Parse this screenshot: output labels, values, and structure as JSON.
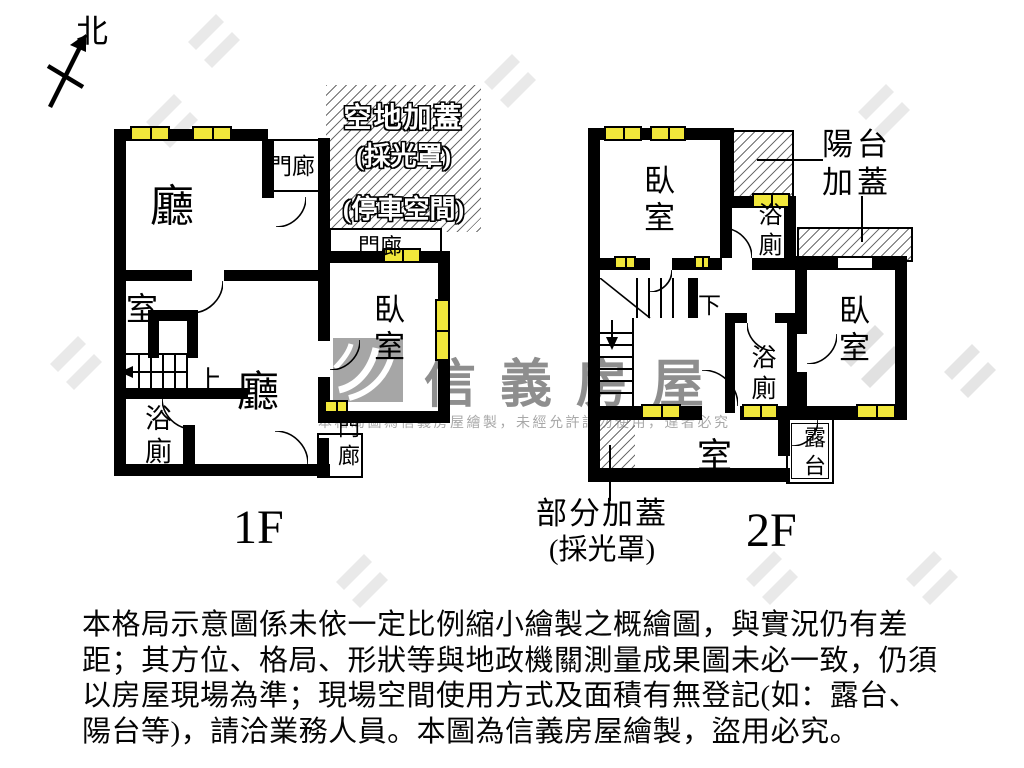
{
  "compass": {
    "north_label": "北"
  },
  "watermark": {
    "brand": "信義房屋",
    "notice": "本格局圖為信義房屋繪製，未經允許請勿使用，違者必究"
  },
  "floor1": {
    "floor_label": "1F",
    "living_room_top": "廳",
    "living_room_main": "廳",
    "porch_top": "門廊",
    "porch_mid": "門廊",
    "porch_bottom": "門廊",
    "bedroom": "臥室",
    "small_room": "室",
    "bathroom": "浴廁",
    "stairs_up": "上",
    "open_cover_line1": "空地加蓋",
    "open_cover_line2": "(採光罩)",
    "open_cover_line3": "(停車空間)"
  },
  "floor2": {
    "floor_label": "2F",
    "bedroom_left": "臥室",
    "bedroom_right": "臥室",
    "bathroom_top": "浴廁",
    "bathroom_mid": "浴廁",
    "room_bottom": "室",
    "terrace": "露台",
    "stairs_down": "下",
    "balcony_cover_line1": "陽台",
    "balcony_cover_line2": "加蓋",
    "partial_cover_line1": "部分加蓋",
    "partial_cover_line2": "(採光罩)"
  },
  "disclaimer": {
    "lines": [
      "本格局示意圖係未依一定比例縮小繪製之概繪圖，與實況仍有差",
      "距；其方位、格局、形狀等與地政機關測量成果圖未必一致，仍須",
      "以房屋現場為準；現場空間使用方式及面積有無登記(如：露台、",
      "陽台等)，請洽業務人員。本圖為信義房屋繪製，盜用必究。"
    ]
  },
  "colors": {
    "wall": "#000000",
    "window": "#f1e73b",
    "watermark_gray": "#8e8e8e"
  }
}
